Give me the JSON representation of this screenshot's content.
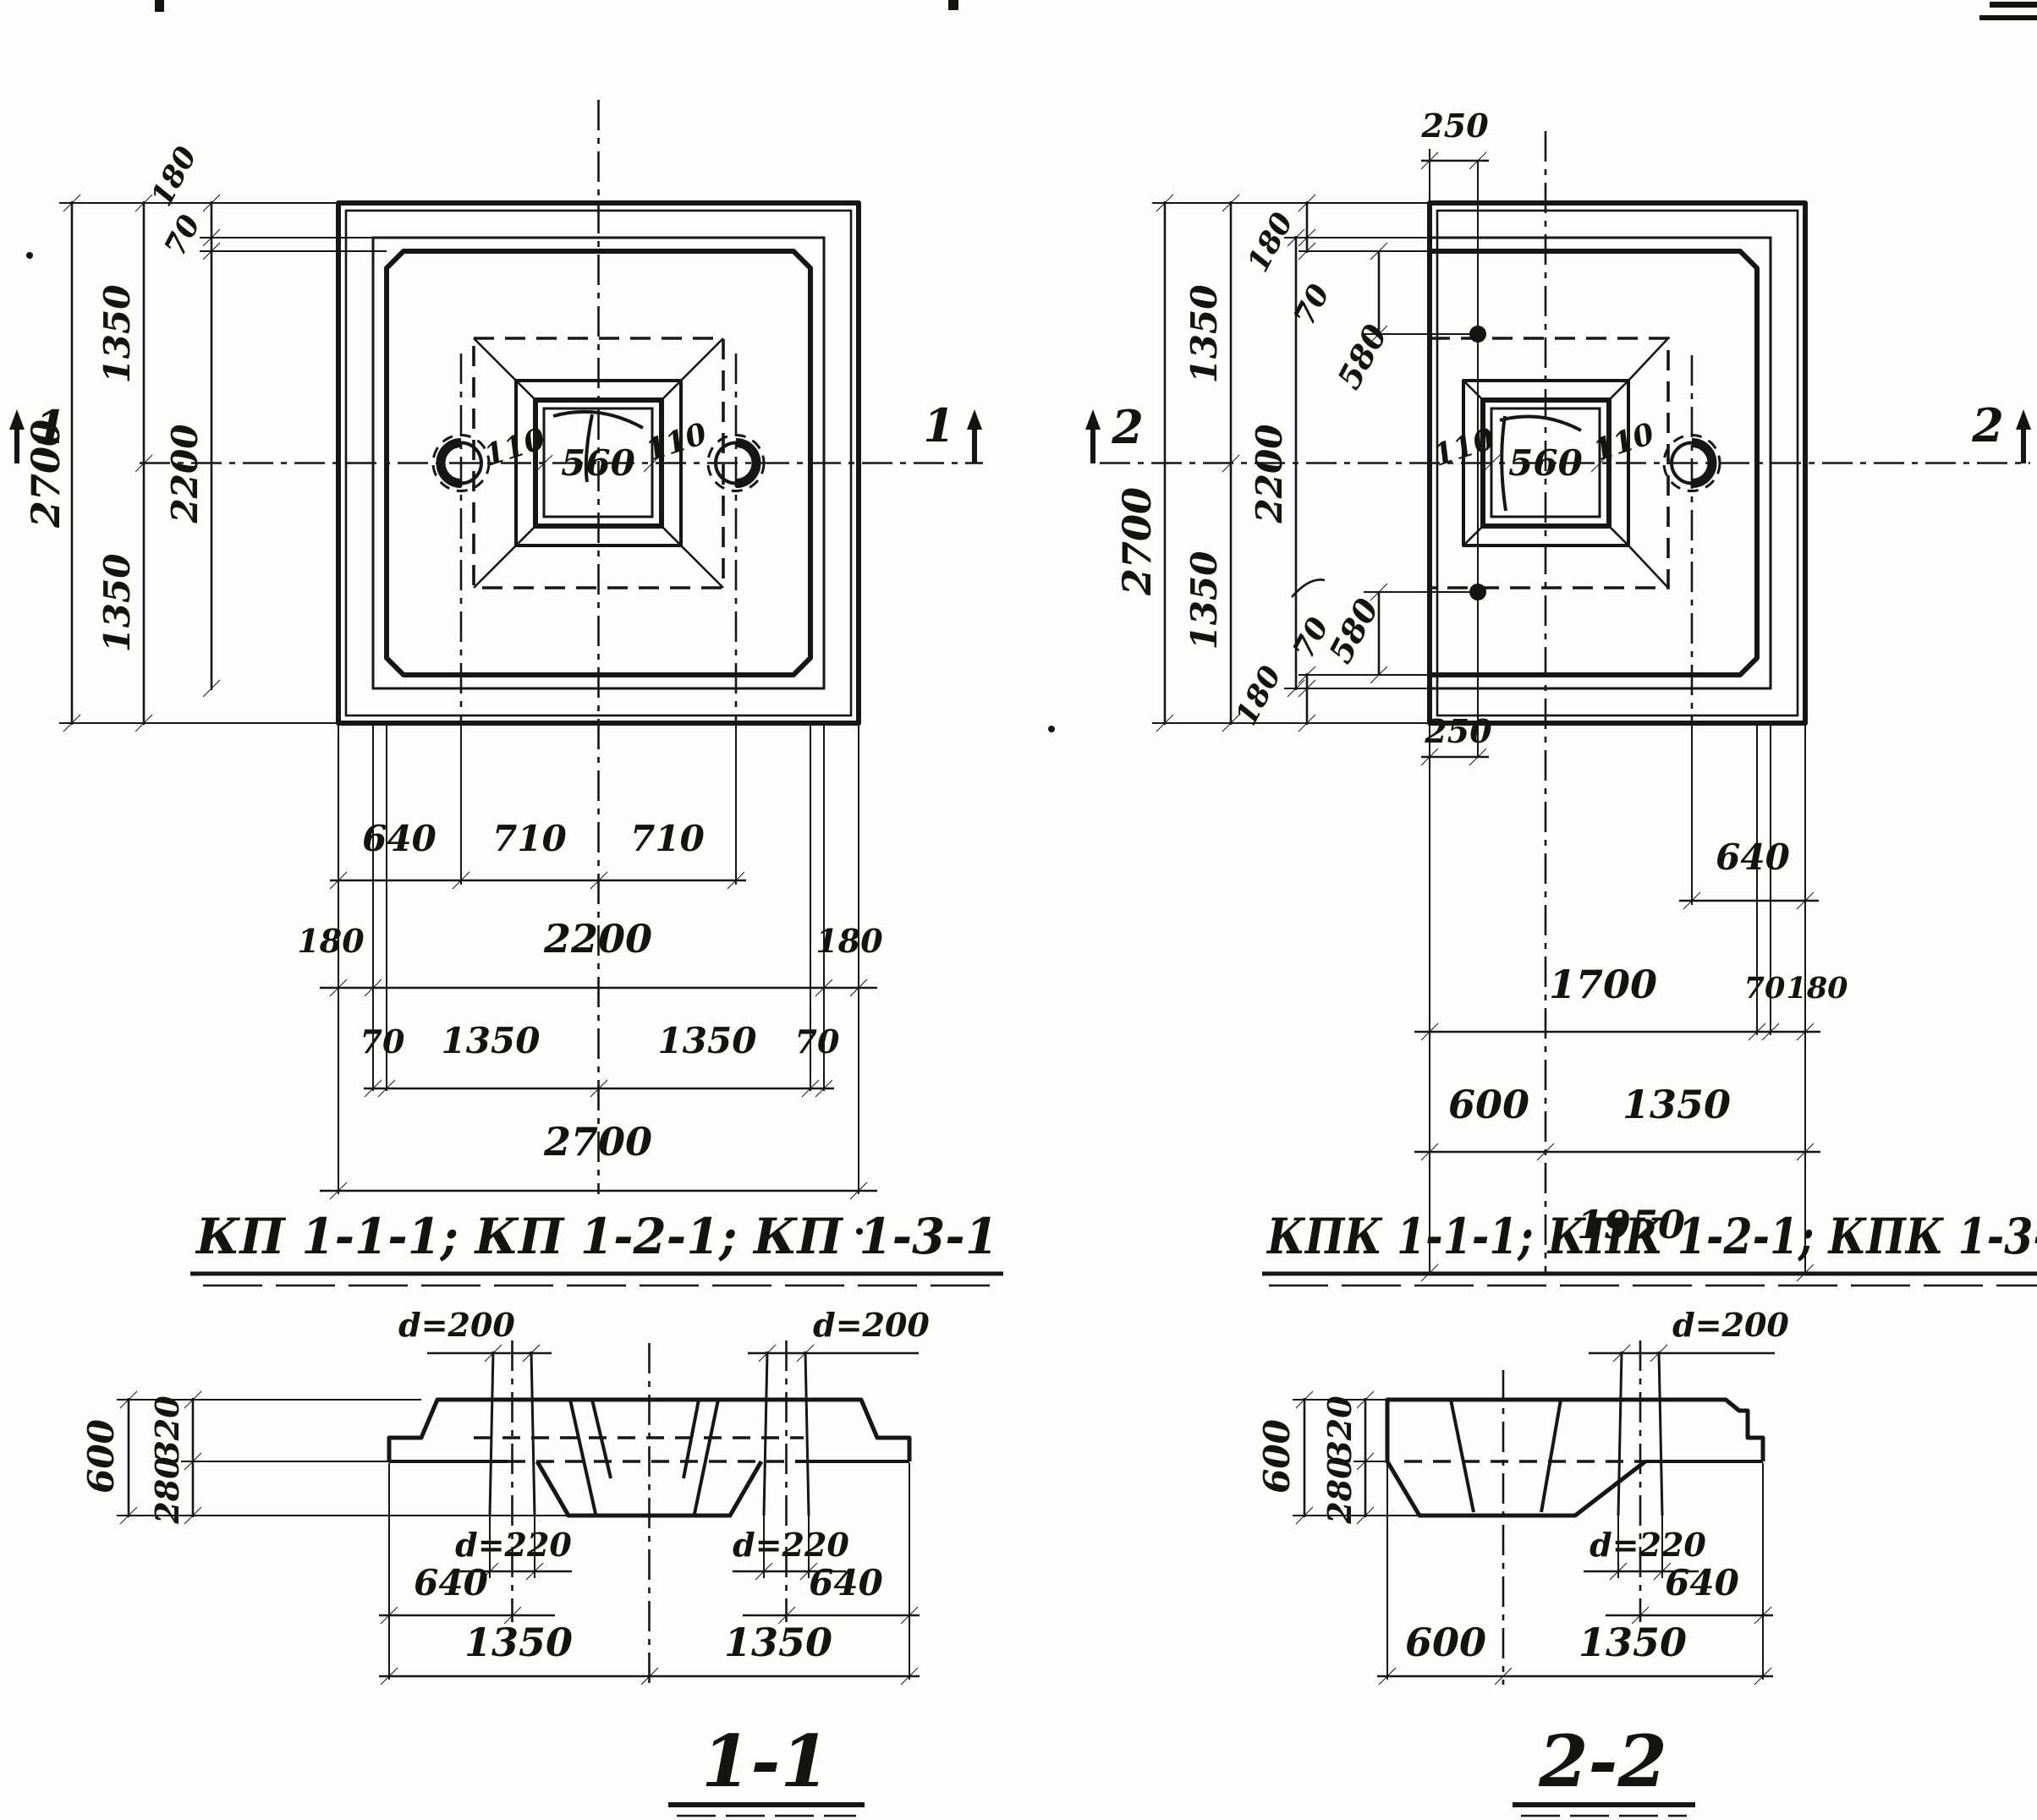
{
  "titles": {
    "plans_left": "КП 1-1-1; КП 1-2-1; КП 1-3-1",
    "plans_right": "КПК 1-1-1; КПК 1-2-1; КПК 1-3-1",
    "section_left": "1-1",
    "section_right": "2-2"
  },
  "plan_left": {
    "marker": "1",
    "dims": {
      "overall_v": "2700",
      "half_top": "1350",
      "half_bottom": "1350",
      "inner_v": "2200",
      "edge_top": "180",
      "step_top": "70",
      "socket_left": "110",
      "socket": "560",
      "socket_right": "110",
      "row1": [
        "640",
        "710",
        "710"
      ],
      "row2": [
        "180",
        "2200",
        "180"
      ],
      "row3": [
        "70",
        "1350",
        "1350",
        "70"
      ],
      "row4": "2700"
    }
  },
  "plan_right": {
    "marker": "2",
    "dims": {
      "top_offset": "250",
      "bottom_offset": "250",
      "overall_v": "2700",
      "half_top": "1350",
      "half_bottom": "1350",
      "inner_v": "2200",
      "edge_top": "180",
      "step_top": "70",
      "hole_top": "580",
      "edge_bottom": "180",
      "step_bottom": "70",
      "hole_bottom": "580",
      "socket_left": "110",
      "socket": "560",
      "socket_right": "110",
      "row1": "640",
      "row2": [
        "1700",
        "70",
        "180"
      ],
      "row3": [
        "600",
        "1350"
      ],
      "row4": "1950"
    }
  },
  "section_1": {
    "dims": {
      "height": "600",
      "upper": "320",
      "lower": "280",
      "hole_top_left": "d=200",
      "hole_top_right": "d=200",
      "hole_bottom_left": "d=220",
      "hole_bottom_right": "d=220",
      "row1": [
        "640",
        "640"
      ],
      "row2": [
        "1350",
        "1350"
      ]
    }
  },
  "section_2": {
    "dims": {
      "height": "600",
      "upper": "320",
      "lower": "280",
      "hole_top": "d=200",
      "hole_bottom": "d=220",
      "row1": "640",
      "row2": [
        "600",
        "1350"
      ]
    }
  }
}
